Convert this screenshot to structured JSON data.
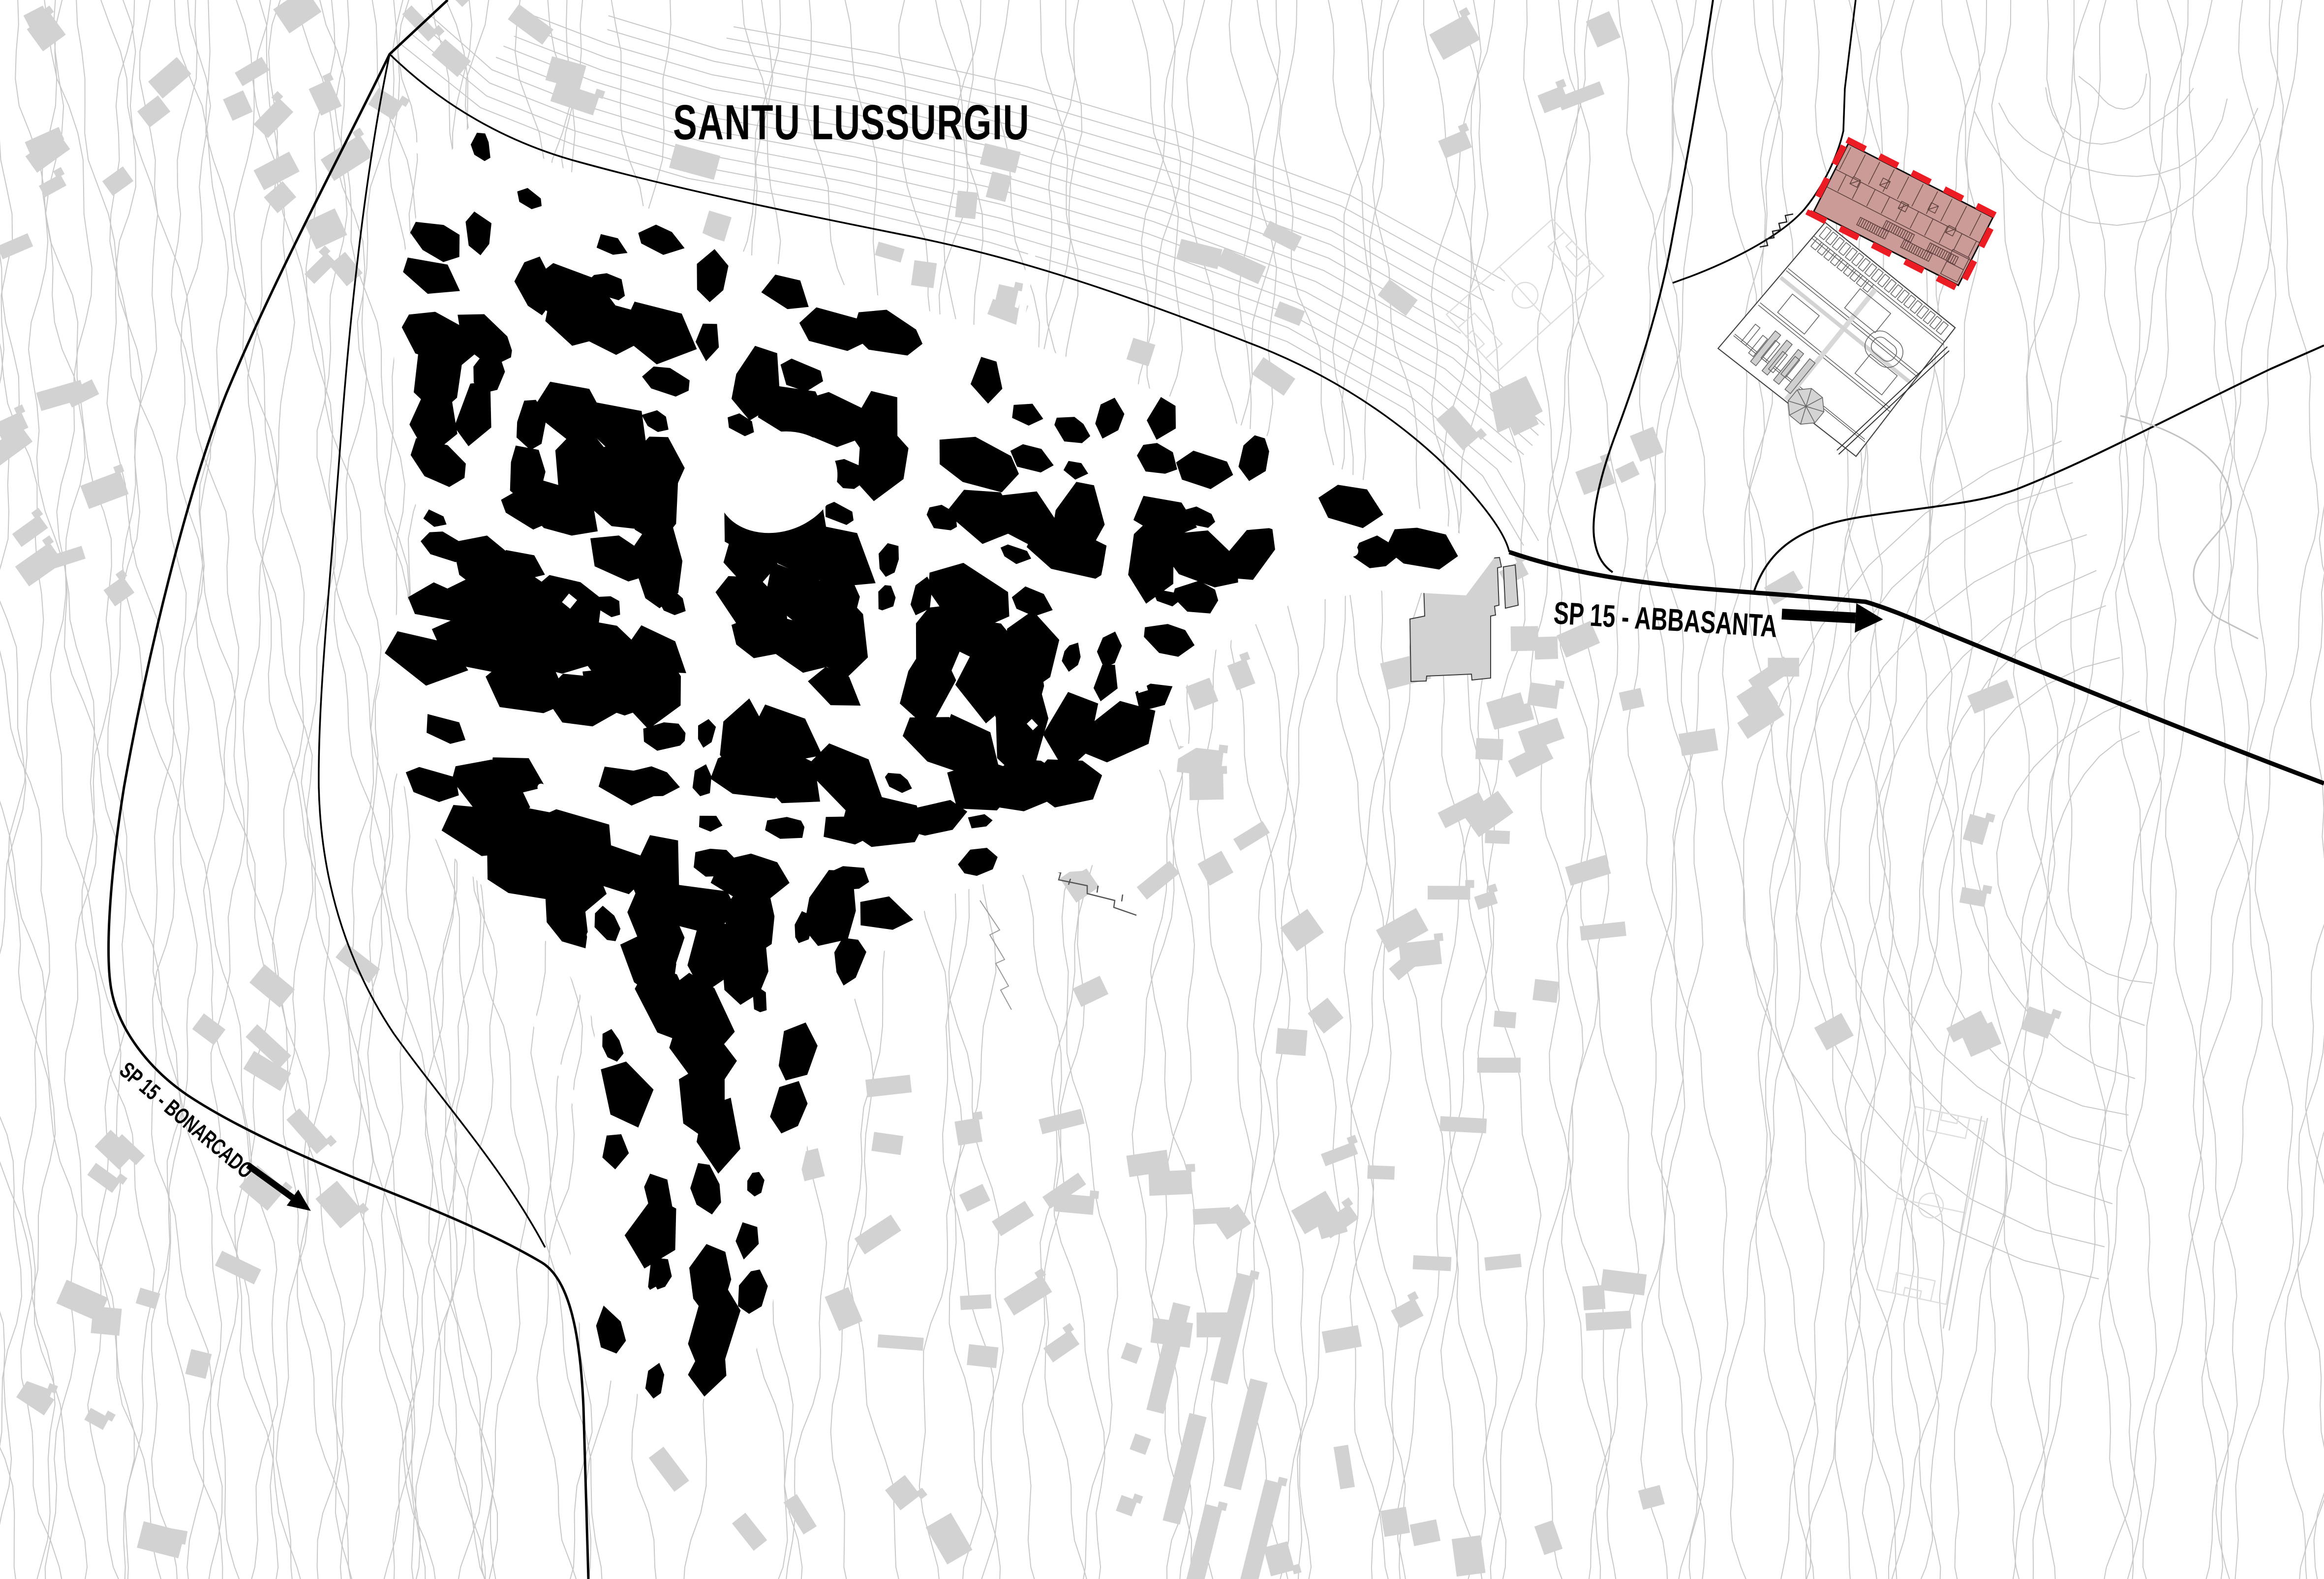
{
  "map": {
    "title": "SANTU LUSSURGIU",
    "roads": {
      "abbasanta": {
        "label": "SP 15 - ABBASANTA",
        "direction": "east"
      },
      "bonarcado": {
        "label": "SP 15 - BONARCADO",
        "direction": "southwest"
      }
    },
    "colors": {
      "background": "#ffffff",
      "historic_core": "#000000",
      "context_buildings": "#d2d2d2",
      "contours": "#c8c8c8",
      "roads": "#000000",
      "site_fill": "#cb9b97",
      "site_line": "#5f4240",
      "site_dash": "#ec1c24",
      "field_lines": "#dedede"
    }
  }
}
